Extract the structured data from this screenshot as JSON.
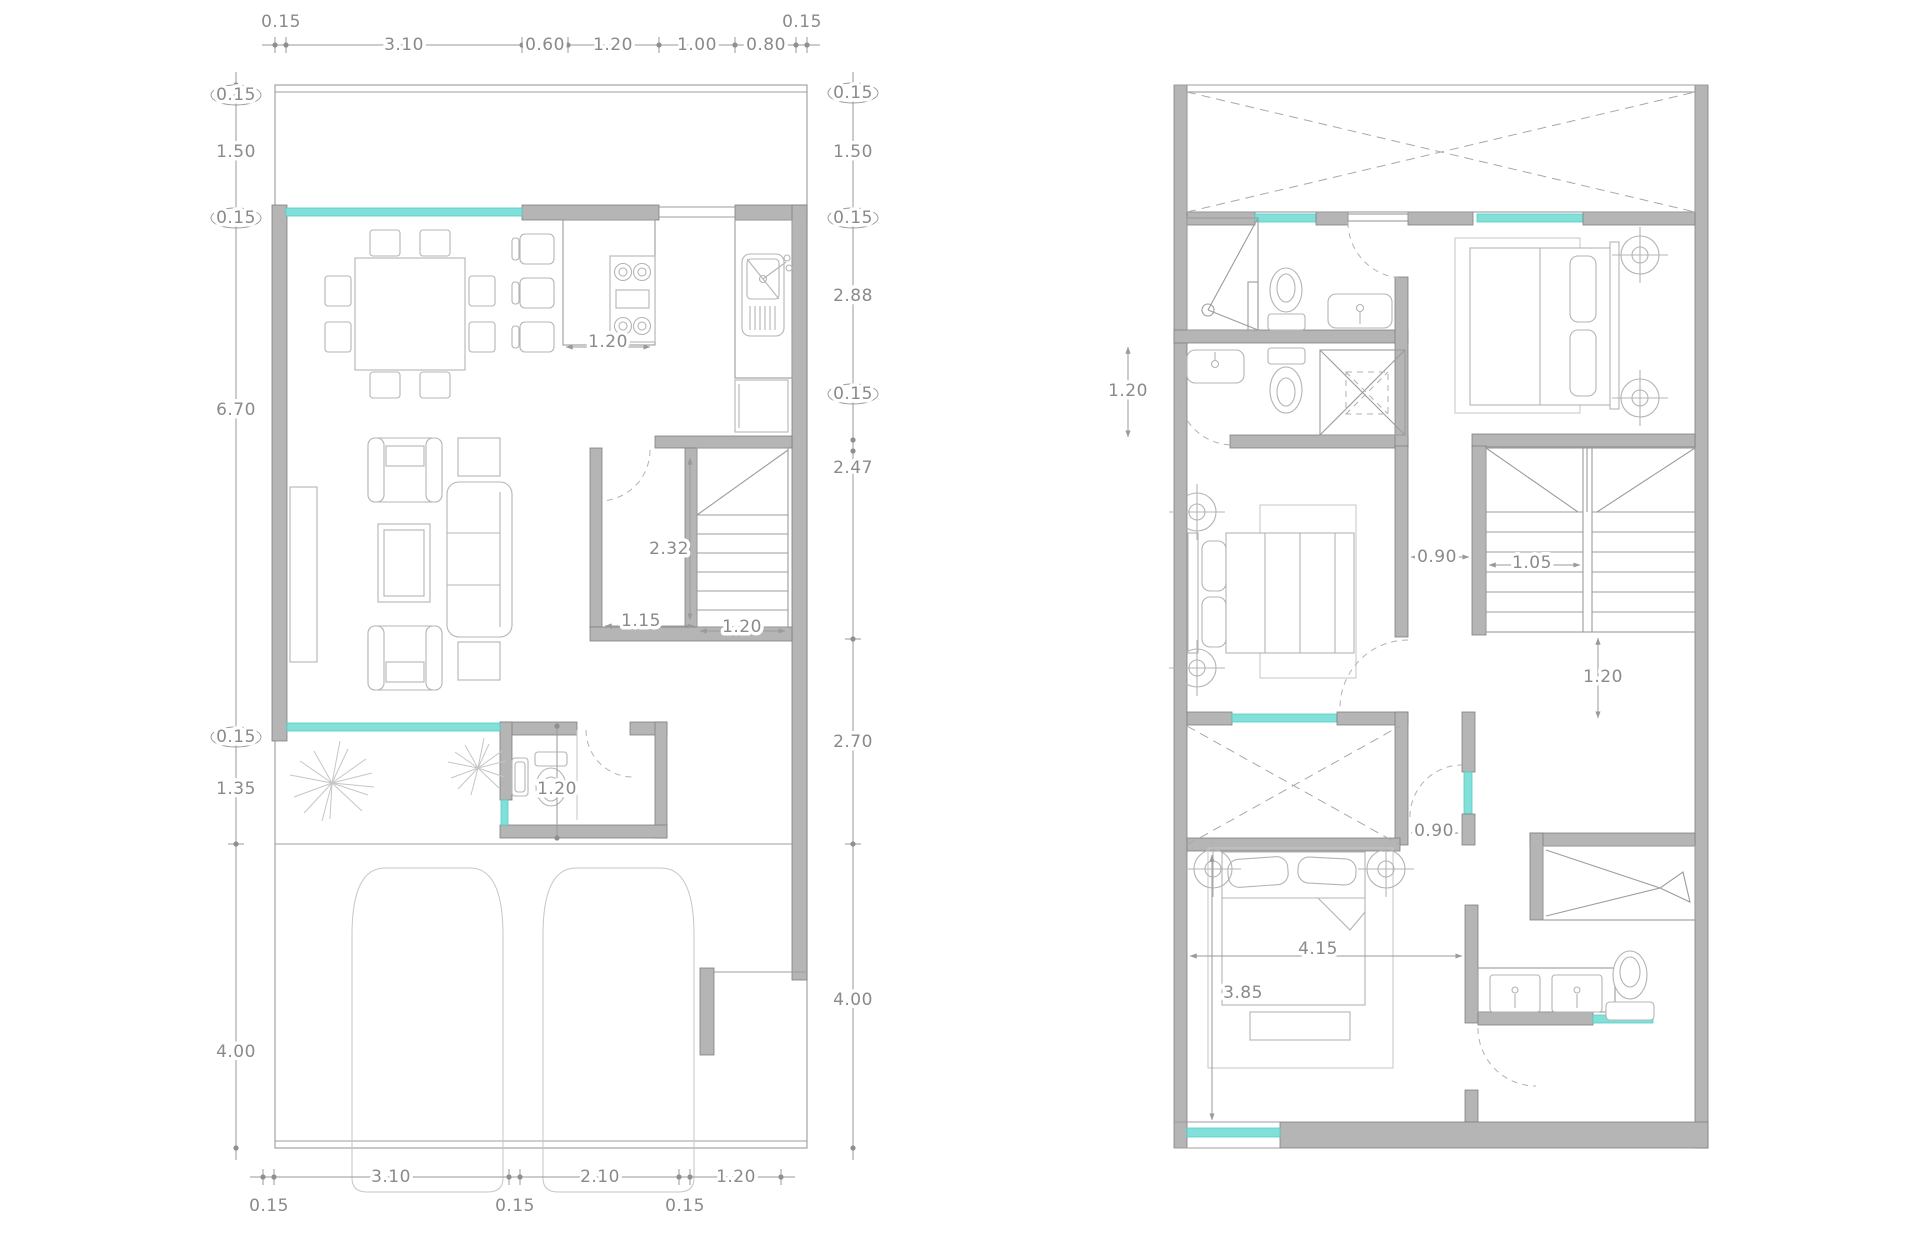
{
  "drawing": {
    "type": "architectural-floor-plan",
    "sheets": 2,
    "colors": {
      "background": "#ffffff",
      "wall_fill": "#b5b5b5",
      "wall_stroke": "#7f7f7f",
      "window_glass": "#83e0d9",
      "dimension_text": "#8a8a8a",
      "line": "#9c9c9c"
    }
  },
  "left_plan": {
    "dims_top": [
      {
        "t": "0.15",
        "x": 281,
        "y": 22
      },
      {
        "t": "3.10",
        "x": 404,
        "y": 45
      },
      {
        "t": "0.60",
        "x": 545,
        "y": 45
      },
      {
        "t": "1.20",
        "x": 613,
        "y": 45
      },
      {
        "t": "1.00",
        "x": 697,
        "y": 45
      },
      {
        "t": "0.80",
        "x": 766,
        "y": 45
      },
      {
        "t": "0.15",
        "x": 802,
        "y": 22
      }
    ],
    "dims_left": [
      {
        "t": "0.15",
        "x": 236,
        "y": 95
      },
      {
        "t": "1.50",
        "x": 236,
        "y": 152
      },
      {
        "t": "0.15",
        "x": 236,
        "y": 218
      },
      {
        "t": "6.70",
        "x": 236,
        "y": 410
      },
      {
        "t": "0.15",
        "x": 236,
        "y": 737
      },
      {
        "t": "1.35",
        "x": 236,
        "y": 789
      },
      {
        "t": "4.00",
        "x": 236,
        "y": 1052
      }
    ],
    "dims_right": [
      {
        "t": "0.15",
        "x": 853,
        "y": 93
      },
      {
        "t": "1.50",
        "x": 853,
        "y": 152
      },
      {
        "t": "0.15",
        "x": 853,
        "y": 218
      },
      {
        "t": "2.88",
        "x": 853,
        "y": 296
      },
      {
        "t": "0.15",
        "x": 853,
        "y": 394
      },
      {
        "t": "2.47",
        "x": 853,
        "y": 468
      },
      {
        "t": "2.70",
        "x": 853,
        "y": 742
      },
      {
        "t": "4.00",
        "x": 853,
        "y": 1000
      }
    ],
    "dims_bottom": [
      {
        "t": "0.15",
        "x": 269,
        "y": 1206
      },
      {
        "t": "3.10",
        "x": 391,
        "y": 1177
      },
      {
        "t": "0.15",
        "x": 515,
        "y": 1206
      },
      {
        "t": "2.10",
        "x": 600,
        "y": 1177
      },
      {
        "t": "0.15",
        "x": 685,
        "y": 1206
      },
      {
        "t": "1.20",
        "x": 736,
        "y": 1177
      }
    ],
    "dims_interior": [
      {
        "t": "1.20",
        "x": 608,
        "y": 342
      },
      {
        "t": "2.32",
        "x": 669,
        "y": 549
      },
      {
        "t": "1.15",
        "x": 641,
        "y": 621
      },
      {
        "t": "1.20",
        "x": 742,
        "y": 627
      },
      {
        "t": "1.20",
        "x": 557,
        "y": 789
      }
    ]
  },
  "right_plan": {
    "dims_interior": [
      {
        "t": "1.20",
        "x": 1128,
        "y": 391
      },
      {
        "t": "0.90",
        "x": 1437,
        "y": 557
      },
      {
        "t": "1.05",
        "x": 1532,
        "y": 563
      },
      {
        "t": "1.20",
        "x": 1603,
        "y": 677
      },
      {
        "t": "0.90",
        "x": 1434,
        "y": 831
      },
      {
        "t": "4.15",
        "x": 1318,
        "y": 949
      },
      {
        "t": "3.85",
        "x": 1243,
        "y": 993
      }
    ]
  }
}
